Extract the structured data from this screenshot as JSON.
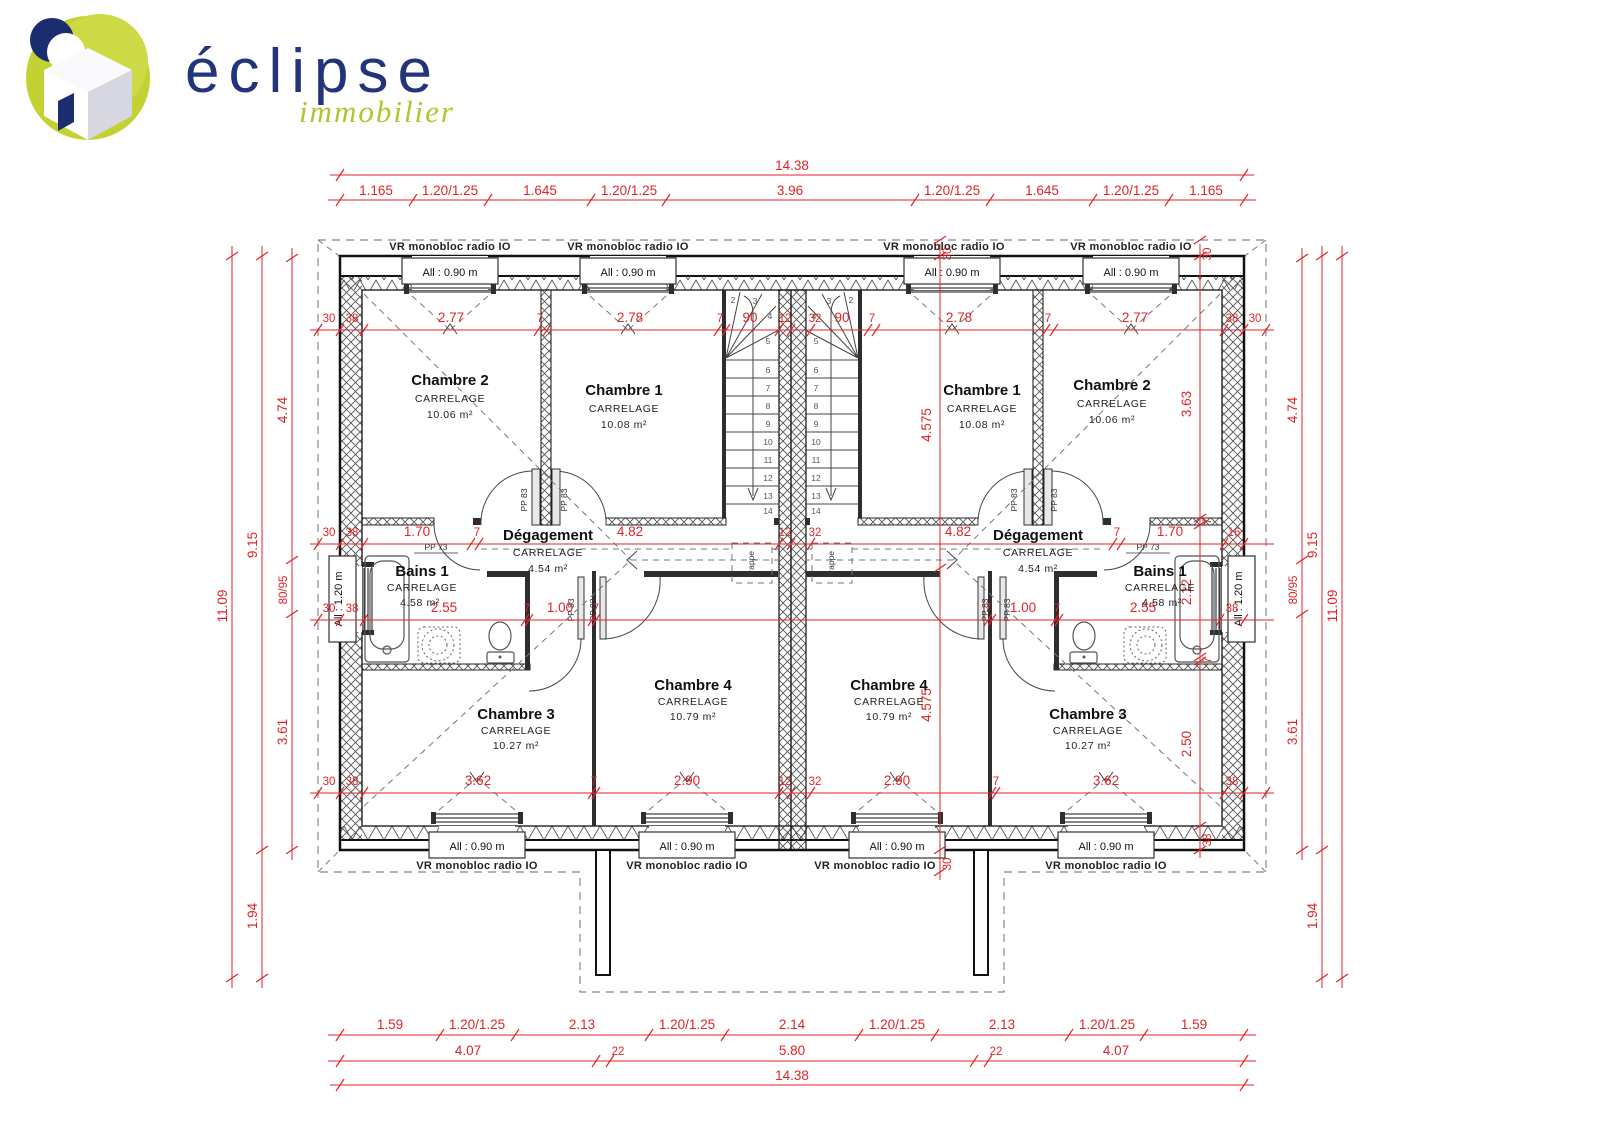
{
  "logo": {
    "brand": "éclipse",
    "tagline": "immobilier"
  },
  "windows": {
    "vr_label": "VR monobloc radio IO",
    "sill_090": "All : 0.90 m",
    "sill_120": "All : 1.20 m"
  },
  "doors": {
    "pp83": "PP 83",
    "pp73": "PP 73"
  },
  "misc": {
    "trappe": "trappe"
  },
  "rooms": {
    "ch1": {
      "name": "Chambre 1",
      "finish": "CARRELAGE",
      "area": "10.08 m²"
    },
    "ch2": {
      "name": "Chambre 2",
      "finish": "CARRELAGE",
      "area": "10.06 m²"
    },
    "ch3": {
      "name": "Chambre 3",
      "finish": "CARRELAGE",
      "area": "10.27 m²"
    },
    "ch4": {
      "name": "Chambre 4",
      "finish": "CARRELAGE",
      "area": "10.79 m²"
    },
    "deg": {
      "name": "Dégagement",
      "finish": "CARRELAGE",
      "area": "4.54 m²"
    },
    "bains": {
      "name": "Bains 1",
      "finish": "CARRELAGE",
      "area": "4.58 m²"
    }
  },
  "dims": {
    "overall_w": "14.38",
    "top_chain": [
      "1.165",
      "1.20/1.25",
      "1.645",
      "1.20/1.25",
      "3.96",
      "1.20/1.25",
      "1.645",
      "1.20/1.25",
      "1.165"
    ],
    "bottom_chain": [
      "1.59",
      "1.20/1.25",
      "2.13",
      "1.20/1.25",
      "2.14",
      "1.20/1.25",
      "2.13",
      "1.20/1.25",
      "1.59"
    ],
    "bottom_chain2": [
      "4.07",
      "22",
      "5.80",
      "22",
      "4.07"
    ],
    "overall_w2": "14.38",
    "left_total": "11.09",
    "left_main": "9.15",
    "left_porch": "1.94",
    "left_inner": [
      "4.74",
      "80/95",
      "3.61"
    ],
    "right_total": "11.09",
    "right_main": "9.15",
    "right_porch": "1.94",
    "right_inner": [
      "4.74",
      "80/95",
      "3.61"
    ],
    "chainA": [
      "30",
      "38",
      "2.77",
      "7",
      "2.78",
      "7",
      "90",
      "12",
      "32",
      "90",
      "7",
      "2.78",
      "7",
      "2.77",
      "38",
      "30"
    ],
    "chainB": [
      "30",
      "38",
      "1.70",
      "7",
      "4.82",
      "12",
      "32",
      "4.82",
      "7",
      "1.70",
      "16"
    ],
    "chainC": [
      "30",
      "38",
      "2.55",
      "7",
      "1.00",
      "7",
      "7",
      "1.00",
      "7",
      "2.55",
      "38"
    ],
    "chainD": [
      "30",
      "38",
      "3.62",
      "7",
      "2.90",
      "12",
      "32",
      "2.90",
      "7",
      "3.62",
      "38"
    ],
    "v940": [
      "30",
      "4.575",
      "4.575",
      "30"
    ],
    "v1200": [
      "30",
      "3.63",
      "7",
      "2.12",
      "7",
      "2.50",
      "38"
    ]
  },
  "stairs": {
    "n": [
      "2",
      "3",
      "4",
      "5",
      "6",
      "7",
      "8",
      "9",
      "10",
      "11",
      "12",
      "13",
      "14"
    ]
  }
}
